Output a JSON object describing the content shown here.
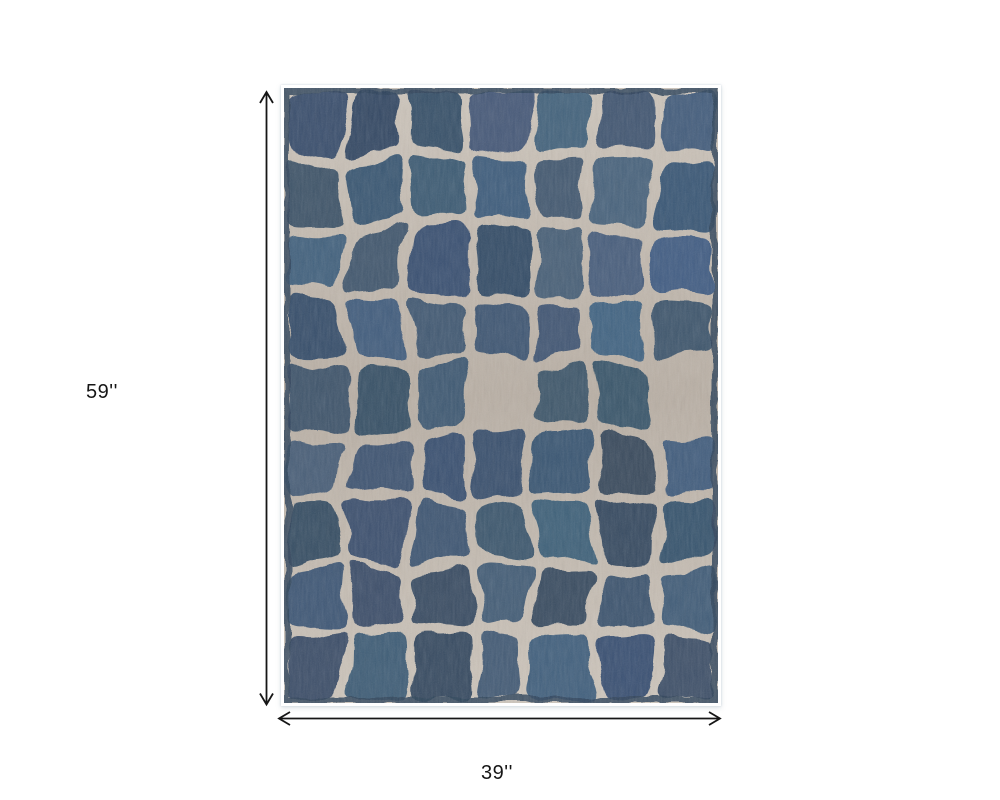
{
  "diagram": {
    "type": "product-dimensions",
    "background": "#ffffff"
  },
  "rug": {
    "description": "Blue and grey abstract crocodile pattern area rug",
    "pattern": "irregular organic grid of navy-blue cells over a beige ground",
    "colors": {
      "cell_blue": "#3b536e",
      "cell_blue_dark": "#2e455c",
      "ground_beige": "#b9afa4",
      "ground_beige_light": "#cec6bc",
      "selvage_navy": "#2c4158",
      "binding_white": "#ffffff"
    },
    "grid": {
      "columns": 7,
      "rows": 9
    }
  },
  "dimensions": {
    "height_label": "59''",
    "width_label": "39''",
    "arrow_color": "#161616"
  }
}
